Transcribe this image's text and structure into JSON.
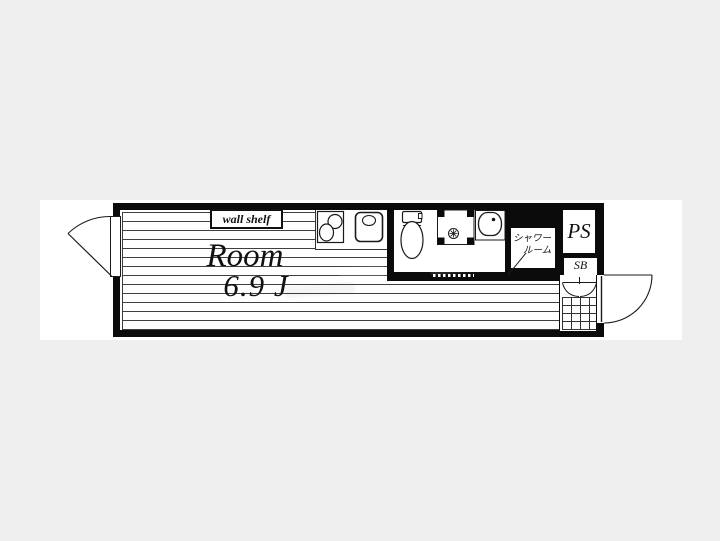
{
  "floorplan": {
    "room": {
      "name": "Room",
      "size": "6.9 J"
    },
    "labels": {
      "wall_shelf": "wall shelf",
      "shower_line1": "シャワー",
      "shower_line2": "ルーム",
      "ps": "PS",
      "sb": "SB"
    },
    "colors": {
      "background": "#efefef",
      "paper": "#ffffff",
      "wall": "#0b0b0b",
      "floor_line": "#3f3f3f"
    },
    "icons": [
      "balcony-door-swing-icon",
      "gas-stove-icon",
      "kitchen-sink-icon",
      "toilet-icon",
      "shower-pan-icon",
      "washbasin-icon",
      "washroom-sliding-door-icon",
      "folding-door-icon",
      "genkan-tiles-icon",
      "entrance-door-swing-icon"
    ]
  }
}
